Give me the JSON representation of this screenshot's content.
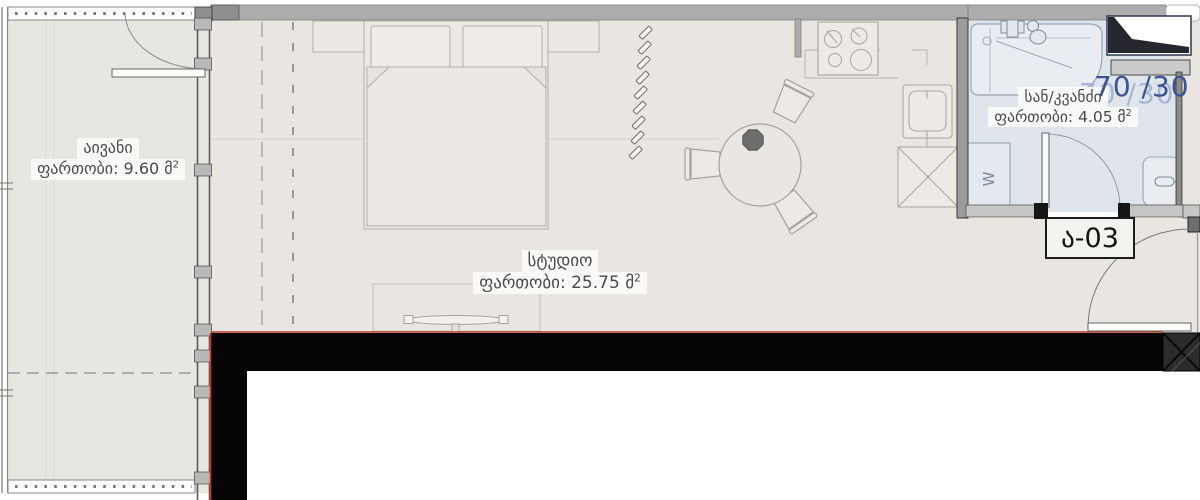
{
  "plan": {
    "scale_badge": "70 /30",
    "unit_label": "ა-03",
    "washer_label": "W",
    "rooms": [
      {
        "id": "balcony",
        "name": "აივანი",
        "area_label": "ფართობი: 9.60 მ",
        "area_sup": "2"
      },
      {
        "id": "studio",
        "name": "სტუდიო",
        "area_label": "ფართობი: 25.75 მ",
        "area_sup": "2"
      },
      {
        "id": "bathroom",
        "name": "სან/კვანძი",
        "area_label": "ფართობი: 4.05 მ",
        "area_sup": "2"
      }
    ],
    "colors": {
      "studio_floor": "#e9e5e1",
      "balcony_floor": "#e4e8e0",
      "bathroom_floor": "#dfe5eb",
      "wall_black": "#050505",
      "wall_grey": "#acacac",
      "accent_red": "#c0392b",
      "badge_blue": "#3a5493",
      "badge_ghost_blue": "#a7b7d4"
    }
  }
}
